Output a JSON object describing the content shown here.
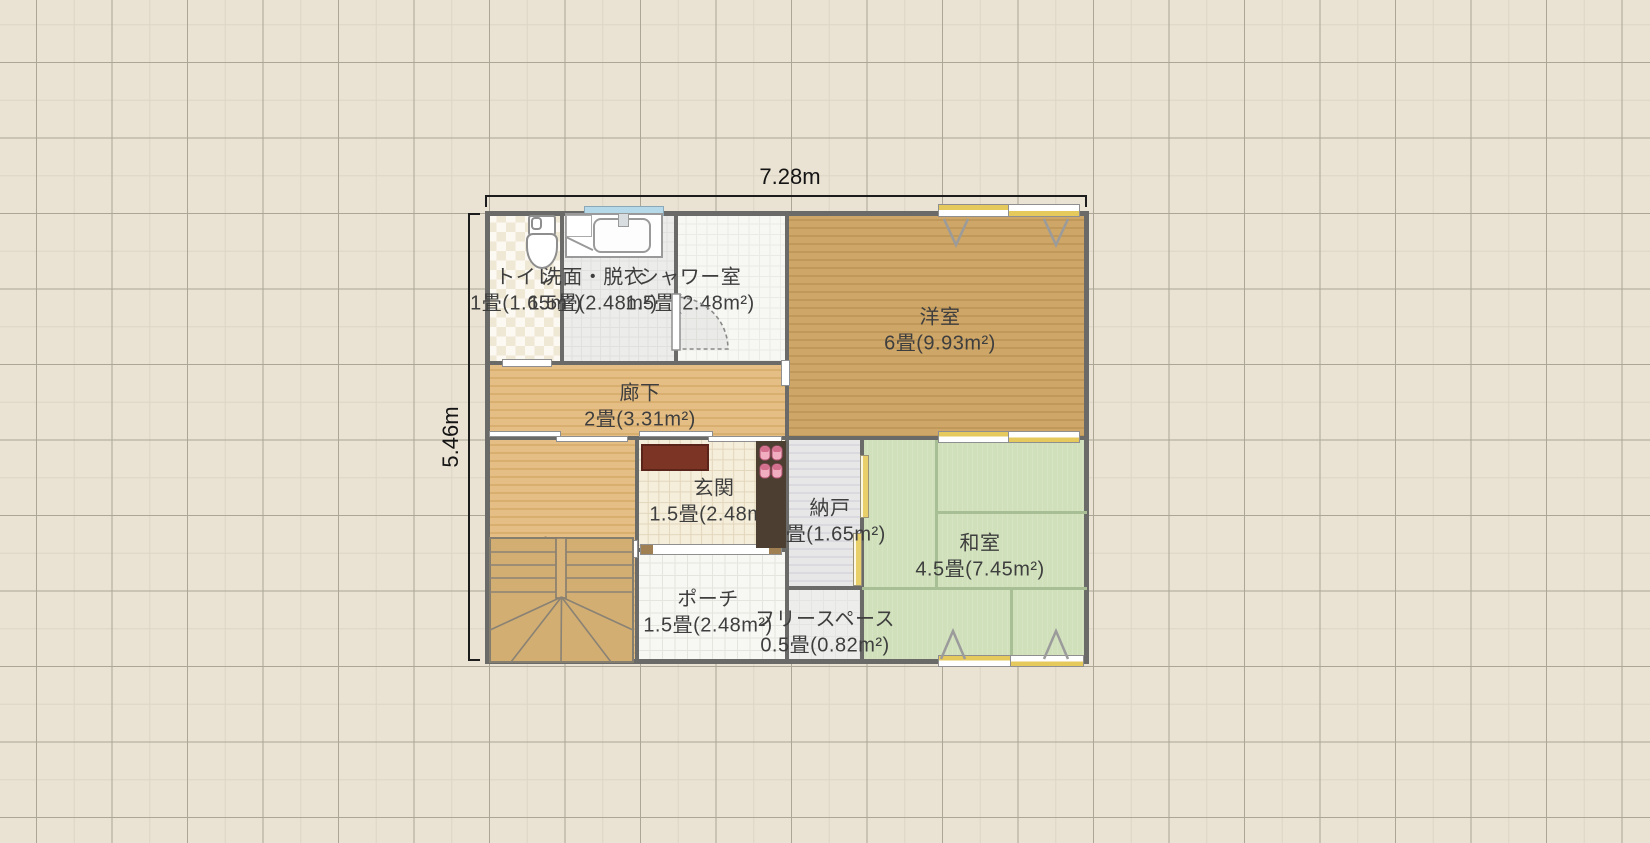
{
  "app": {
    "view": "floor-plan-canvas"
  },
  "dimensions": {
    "width_label": "7.28m",
    "height_label": "5.46m"
  },
  "colors": {
    "canvas_bg": "#eae2d2",
    "grid_major": "#aba695",
    "grid_minor": "#dcd5c5",
    "wall": "#6a6a68",
    "tatami": "#cfe0ba",
    "tatami_line": "#a8bf96",
    "wood_dark": "#cda668",
    "wood_light": "#e4be85",
    "door_panel_yellow": "#e6c95c",
    "window_blue": "#b5d9e8",
    "entrance_mat_red": "#7c3424",
    "label_text": "#3e3e3e"
  },
  "plan": {
    "origin": {
      "x": 487,
      "y": 213,
      "w": 600,
      "h": 450
    },
    "rooms": [
      {
        "id": "toilet",
        "name": "トイレ",
        "area": "1畳(1.65m²)",
        "rect": [
          487,
          213,
          75,
          150
        ],
        "floor": "checker",
        "lx": 526,
        "ly": 288
      },
      {
        "id": "washroom",
        "name": "洗面・脱衣",
        "area": "1.5畳(2.48m²)",
        "rect": [
          562,
          213,
          113,
          150
        ],
        "floor": "graydot",
        "lx": 593,
        "ly": 288
      },
      {
        "id": "shower-room",
        "name": "シャワー室",
        "area": "1.5畳(2.48m²)",
        "rect": [
          675,
          213,
          112,
          150
        ],
        "floor": "whitetile",
        "lx": 690,
        "ly": 288
      },
      {
        "id": "western-room",
        "name": "洋室",
        "area": "6畳(9.93m²)",
        "rect": [
          787,
          213,
          300,
          225
        ],
        "floor": "wood_dark",
        "lx": 940,
        "ly": 328
      },
      {
        "id": "hallway",
        "name": "廊下",
        "area": "2畳(3.31m²)",
        "rect": [
          487,
          363,
          300,
          75
        ],
        "floor": "wood_light",
        "lx": 640,
        "ly": 404
      },
      {
        "id": "hall",
        "name": "ホール",
        "area": "3畳(4.96m²)",
        "rect": [
          487,
          438,
          150,
          225
        ],
        "floor": "wood_light",
        "lx": 566,
        "ly": 557
      },
      {
        "id": "entrance",
        "name": "玄関",
        "area": "1.5畳(2.48m²)",
        "rect": [
          637,
          438,
          150,
          112
        ],
        "floor": "tile_cream",
        "lx": 714,
        "ly": 499
      },
      {
        "id": "storage",
        "name": "納戸",
        "area": "1畳(1.65m²)",
        "rect": [
          787,
          438,
          75,
          150
        ],
        "floor": "stripes_gray",
        "lx": 830,
        "ly": 519
      },
      {
        "id": "japanese-room",
        "name": "和室",
        "area": "4.5畳(7.45m²)",
        "rect": [
          862,
          438,
          225,
          225
        ],
        "floor": "tatami",
        "lx": 980,
        "ly": 554
      },
      {
        "id": "porch",
        "name": "ポーチ",
        "area": "1.5畳(2.48m²)",
        "rect": [
          637,
          550,
          150,
          113
        ],
        "floor": "tile_white",
        "lx": 708,
        "ly": 610
      },
      {
        "id": "free-space",
        "name": "フリースペース",
        "area": "0.5畳(0.82m²)",
        "rect": [
          787,
          588,
          75,
          75
        ],
        "floor": "plain_light",
        "lx": 825,
        "ly": 630
      }
    ],
    "walls": [
      [
        485,
        211,
        604,
        5
      ],
      [
        485,
        659,
        604,
        5
      ],
      [
        485,
        211,
        5,
        453
      ],
      [
        1084,
        211,
        5,
        453
      ],
      [
        560,
        213,
        4,
        152
      ],
      [
        674,
        213,
        4,
        84
      ],
      [
        674,
        346,
        4,
        19
      ],
      [
        785,
        213,
        4,
        450
      ],
      [
        487,
        361,
        300,
        4
      ],
      [
        487,
        436,
        600,
        4
      ],
      [
        635,
        440,
        4,
        223
      ],
      [
        637,
        548,
        148,
        4
      ],
      [
        787,
        586,
        75,
        4
      ],
      [
        860,
        440,
        4,
        223
      ]
    ],
    "tatami_lines": [
      [
        935,
        440,
        3,
        148
      ],
      [
        938,
        511,
        149,
        3
      ],
      [
        862,
        587,
        225,
        3
      ],
      [
        1010,
        590,
        3,
        73
      ]
    ],
    "openings": [
      {
        "type": "white",
        "rect": [
          502,
          359,
          50,
          8
        ],
        "name": "toilet-door"
      },
      {
        "type": "double",
        "rect": [
          489,
          431,
          139,
          11
        ],
        "name": "hall-sliding-door"
      },
      {
        "type": "double",
        "rect": [
          639,
          431,
          143,
          11
        ],
        "name": "entrance-sliding-door"
      },
      {
        "type": "white",
        "rect": [
          781,
          360,
          9,
          26
        ],
        "name": "western-room-door"
      },
      {
        "type": "blue",
        "rect": [
          584,
          206,
          80,
          10
        ],
        "name": "washroom-window"
      },
      {
        "type": "yellow_h",
        "rect": [
          938,
          204,
          142,
          13
        ],
        "name": "western-room-window"
      },
      {
        "type": "yellow_h",
        "rect": [
          938,
          431,
          142,
          12
        ],
        "name": "western-japanese-partition-door"
      },
      {
        "type": "yellow_h",
        "rect": [
          938,
          655,
          146,
          12
        ],
        "name": "japanese-room-window"
      },
      {
        "type": "yellow_v",
        "rect": [
          860,
          455,
          9,
          63
        ],
        "name": "storage-closet-door-upper"
      },
      {
        "type": "yellow_v",
        "rect": [
          853,
          533,
          9,
          53
        ],
        "name": "storage-closet-door-lower"
      },
      {
        "type": "caps",
        "rect": [
          640,
          544,
          142,
          11
        ],
        "name": "front-door"
      },
      {
        "type": "white",
        "rect": [
          627,
          540,
          11,
          18
        ],
        "name": "porch-wall-fixture"
      }
    ],
    "fixtures": [
      {
        "name": "toilet-icon",
        "room": "トイレ"
      },
      {
        "name": "washbasin-icon",
        "room": "洗面・脱衣"
      },
      {
        "name": "door-swing-icon",
        "room": "シャワー室"
      },
      {
        "name": "staircase-icon",
        "room": "ホール"
      },
      {
        "name": "entrance-mat",
        "room": "玄関"
      },
      {
        "name": "slippers-icon",
        "room": "玄関"
      },
      {
        "name": "casement-window-marks",
        "room": "洋室"
      },
      {
        "name": "casement-window-marks",
        "room": "和室"
      }
    ]
  }
}
